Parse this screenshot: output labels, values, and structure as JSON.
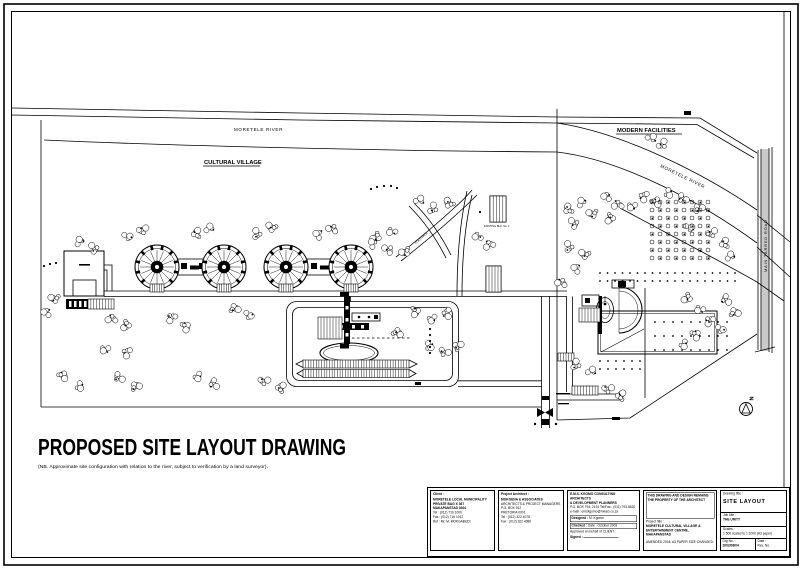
{
  "page": {
    "title": "PROPOSED SITE LAYOUT DRAWING",
    "note": "(NB.  Approximate site configuration with relation to the river, subject to verification by a land surveyor)."
  },
  "map": {
    "labels": {
      "river_left": "MORETELE RIVER",
      "river_right": "MORETELE RIVER",
      "cultural_village": "CULTURAL VILLAGE",
      "modern_facilities": "MODERN FACILITIES",
      "road_vertical": "MAIN TARRED ROAD",
      "footpath": "FOOTPATH",
      "existing_bldg": "EXISTING BLD. No. 1",
      "north": "N"
    }
  },
  "title_block": {
    "client": {
      "header": "Client :",
      "lines": [
        "MORETELE LOCAL MUNICIPALITY",
        "PRIVATE BAG X 367",
        "MAKAPANSTAD  0404",
        "Tel : (012) 716 1000",
        "Fax : (012) 716 1012",
        "Ref : Mr. M. MOKGABUDI"
      ]
    },
    "architect": {
      "header": "Project Architect :",
      "lines": [
        "MOKOENA & ASSOCIATES",
        "ARCHITECTS & PROJECT MANAGERS",
        "P.O. BOX 912",
        "PRETORIA  0001",
        "Tel : (012) 322 4075",
        "Fax : (012) 322 4080"
      ]
    },
    "consultant": {
      "lines": [
        "E.M.S. KGOMO CONSULTING ARCHITECTS",
        "& DEVELOPMENT PLANNERS",
        "P.O. BOX 794, 2191   Tel/Fax : (011) 793-5620",
        "e-mail : emskgomo@mweb.co.za"
      ],
      "designed_label": "Designed :",
      "designed": "M. Kgomo",
      "checked_label": "Checked :",
      "checked": "Date : October 2003",
      "approved": "Approved on behalf of CLIENT :",
      "signed_label": "Signed :"
    },
    "ownership": {
      "heading": "THIS DRAWING AND DESIGN REMAINS THE PROPERTY OF THE ARCHITECT",
      "project_title_label": "Project title :",
      "project_title_line1": "MORETELE CULTURAL VILLAGE &",
      "project_title_line2": "ENTERTAINMENT CENTRE, MAKAPANSTAD",
      "note": "AMENDED 2004, A3 PAPER SIZE CHANGED."
    },
    "drawing": {
      "drawing_title_label": "Drawing title :",
      "drawing_title": "SITE LAYOUT",
      "job_title_label": "Job title :",
      "job_title": "THE UNITY",
      "scales_label": "Scales :",
      "scales": "1:500 scaled to 1:1000 (A3 paper)",
      "drg_label": "Drg No. :",
      "drg_no": "2003/08/04",
      "date_label": "Date :",
      "rev_label": "Rev. No."
    }
  }
}
